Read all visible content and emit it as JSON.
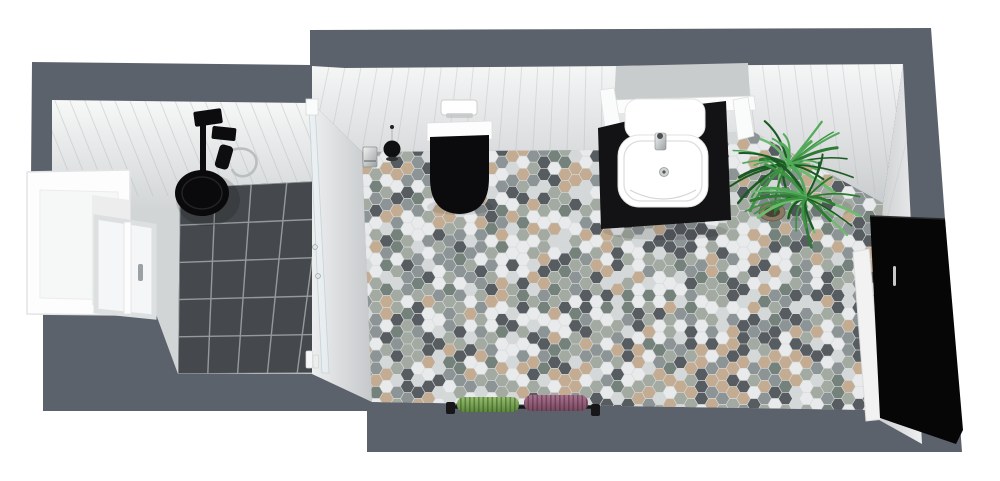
{
  "scene": {
    "description": "3D top-down rendering of a bathroom floor plan",
    "room": "bathroom",
    "view": "top-down perspective"
  },
  "colors": {
    "background": "#ffffff",
    "wall_outer": "#5c626b",
    "wall_face_light": "#f3f4f5",
    "wall_face_shade": "#c7cacc",
    "panel_line": "#b7bcbf",
    "shower_tile": "#45494d",
    "shower_grout": "#949a9c",
    "floor_grout": "#d7dadc",
    "glass": "#e8f0f3",
    "chrome": "#c2c7c9",
    "fixture_black": "#0b0b0d",
    "ceramic_white": "#fefefe",
    "mirror_gray": "#c9cccd",
    "vanity_black": "#131315",
    "cabinet_black": "#060607",
    "pot_brown": "#8a7a64",
    "towel_green": "#7dab52",
    "towel_purple": "#96607a",
    "rail_black": "#17171a"
  },
  "floor_tiles": {
    "shape": "hexagon",
    "orientation": "flat-top",
    "tile_width_px": 14,
    "palette": [
      {
        "color": "#e8eaeb",
        "weight": 20
      },
      {
        "color": "#d4d8d9",
        "weight": 10
      },
      {
        "color": "#a3aaa1",
        "weight": 17
      },
      {
        "color": "#8d9495",
        "weight": 16
      },
      {
        "color": "#575c60",
        "weight": 15
      },
      {
        "color": "#c3ac92",
        "weight": 13
      },
      {
        "color": "#75827b",
        "weight": 9
      }
    ]
  },
  "plant": {
    "leaf_colors": [
      "#1c5a23",
      "#2d7a33",
      "#3d9343",
      "#52a95a",
      "#6cbb6e"
    ]
  },
  "objects": [
    {
      "id": "outer-walls",
      "label": "exterior walls"
    },
    {
      "id": "window-bay",
      "label": "window with deep sill"
    },
    {
      "id": "shower-area",
      "label": "walk-in shower with dark square tiles"
    },
    {
      "id": "rain-shower-head",
      "label": "black rain shower head with hand shower"
    },
    {
      "id": "glass-partition",
      "label": "glass shower screen"
    },
    {
      "id": "shampoo-bottles",
      "label": "shampoo bottles"
    },
    {
      "id": "toilet",
      "label": "wall-hung toilet with black seat"
    },
    {
      "id": "flush-plate",
      "label": "flush plate"
    },
    {
      "id": "toilet-brush",
      "label": "toilet brush"
    },
    {
      "id": "toilet-paper-holder",
      "label": "toilet paper holder"
    },
    {
      "id": "washbasin",
      "label": "washbasin on black vanity"
    },
    {
      "id": "mirror",
      "label": "vanity mirror"
    },
    {
      "id": "potted-plant",
      "label": "potted green plant"
    },
    {
      "id": "tall-cabinet",
      "label": "tall black storage cabinet"
    },
    {
      "id": "towel-rail",
      "label": "towel rail with green and purple towels"
    },
    {
      "id": "hex-floor",
      "label": "hexagonal mosaic tile floor"
    }
  ]
}
